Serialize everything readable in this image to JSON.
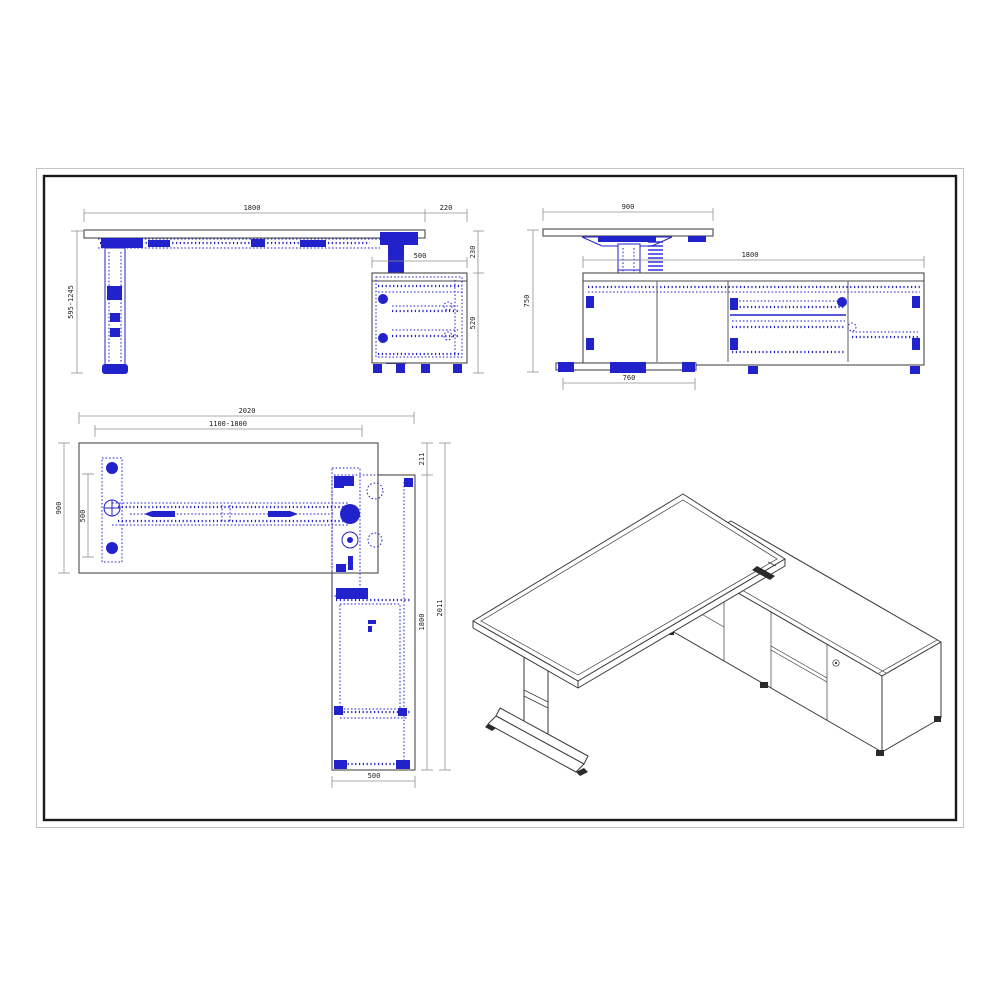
{
  "page": {
    "background": "#ffffff",
    "frame_outer_color": "#c4c4c4",
    "frame_inner_color": "#1a1a1a"
  },
  "colors": {
    "drawing_blue": "#2222cc",
    "dimension_line": "#8f8f8f",
    "dimension_text": "#1c1c1c",
    "outline_dark": "#4a4a4a",
    "isometric_line": "#3a3a3a"
  },
  "views": {
    "front_elevation": {
      "title": "front-elevation-of-desk-with-cabinet",
      "dims": {
        "desk_width": "1800",
        "overhang": "220",
        "top_to_cabinet": "230",
        "cabinet_width": "500",
        "cabinet_height": "520",
        "height_range": "595-1245"
      }
    },
    "side_elevation": {
      "title": "side-elevation-of-desk-with-credenza",
      "dims": {
        "desk_depth": "900",
        "credenza_length": "1800",
        "overall_height": "750",
        "foot_length": "760"
      }
    },
    "plan_view": {
      "title": "plan-view-of-l-desk",
      "dims": {
        "overall_length": "2020",
        "desk_width_range": "1100-1800",
        "desk_depth": "900",
        "leg_frame_span": "500",
        "corner_gap": "211",
        "cabinet_length": "1800",
        "overall_depth": "2011",
        "cabinet_depth": "500"
      }
    },
    "isometric_view": {
      "title": "isometric-view-of-height-adjustable-l-desk"
    }
  }
}
